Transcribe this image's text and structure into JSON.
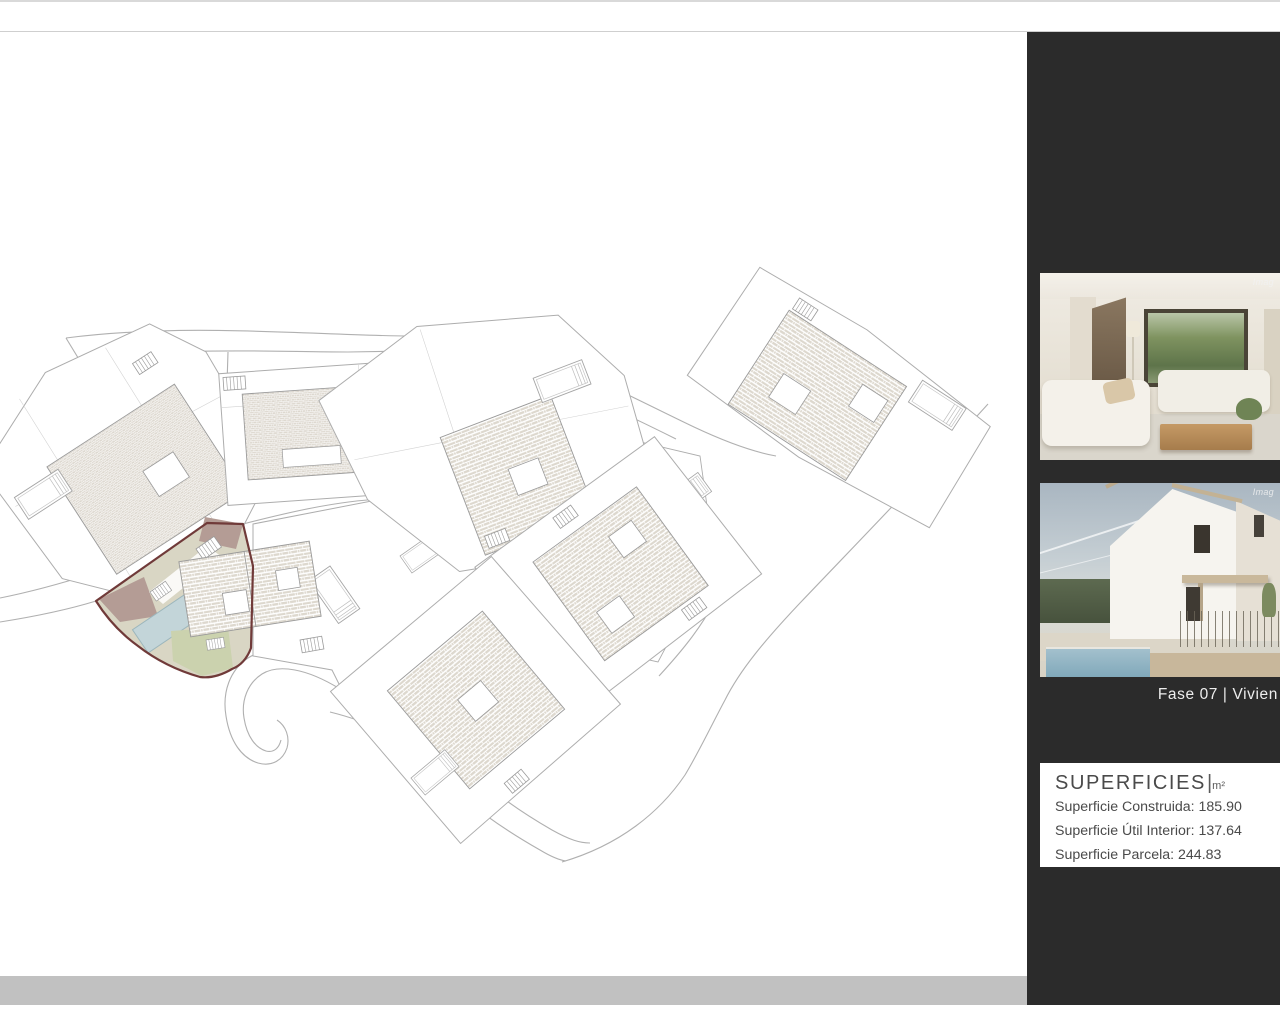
{
  "sidebar": {
    "background": "#2b2b2b",
    "caption": "Fase 07 |  Vivien",
    "photo1_watermark": "Imag",
    "photo2_watermark": "Imag",
    "superficies": {
      "title": "SUPERFICIES",
      "separator": "|",
      "unit": "m²",
      "lines": [
        "Superficie Construida:  185.90",
        "Superficie Útil Interior: 137.64",
        "Superficie Parcela: 244.83"
      ]
    }
  },
  "plan": {
    "line_color": "#adadad",
    "building_line_color": "#9a9a9a",
    "roof_fill": "#ddd8ce",
    "footer_bar_color": "#c1c1c1",
    "highlight": {
      "plot_fill": "#d9d6c4",
      "border_color": "#703a39",
      "terrace_fill": "#b49c95",
      "pool_fill": "#c3d5d9",
      "garden_fill": "#cbd2ae"
    }
  }
}
